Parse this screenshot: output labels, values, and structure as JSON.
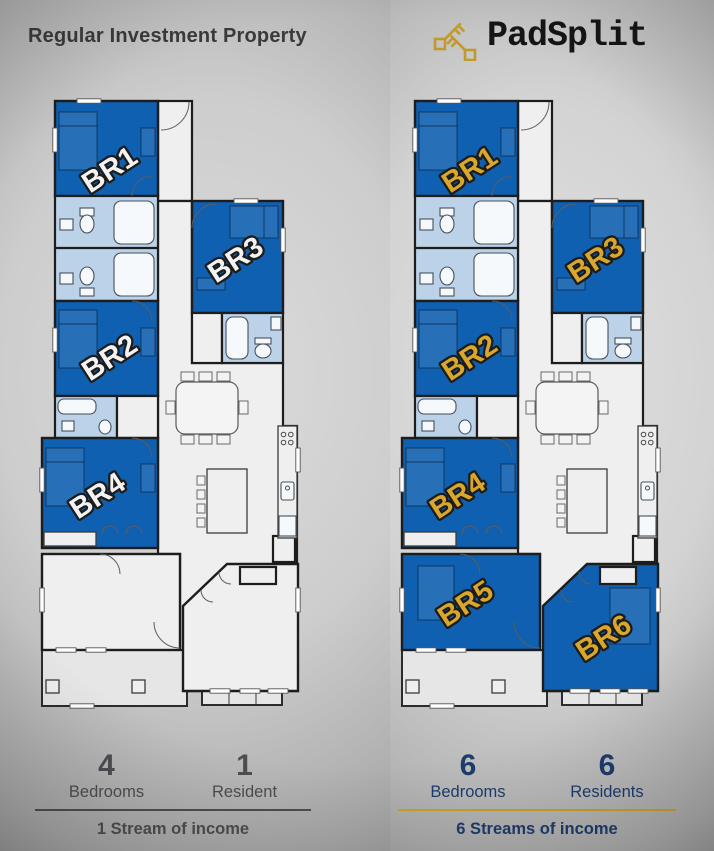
{
  "header": {
    "title": "Regular Investment Property",
    "brand": "PadSplit",
    "brand_icon": "keys-icon"
  },
  "plans": {
    "left": {
      "name": "regular-floorplan",
      "label_color": "#f3f3f3",
      "extra_room_fill": "#efefef",
      "rooms": [
        {
          "label": "BR1"
        },
        {
          "label": "BR2"
        },
        {
          "label": "BR3"
        },
        {
          "label": "BR4"
        }
      ]
    },
    "right": {
      "name": "padsplit-floorplan",
      "label_color": "#d9a72c",
      "extra_room_fill": "#0f60b0",
      "rooms": [
        {
          "label": "BR1"
        },
        {
          "label": "BR2"
        },
        {
          "label": "BR3"
        },
        {
          "label": "BR4"
        },
        {
          "label": "BR5"
        },
        {
          "label": "BR6"
        }
      ]
    }
  },
  "stats": {
    "left": {
      "items": [
        {
          "value": "4",
          "label": "Bedrooms"
        },
        {
          "value": "1",
          "label": "Resident"
        }
      ],
      "income": "1 Stream of income"
    },
    "right": {
      "items": [
        {
          "value": "6",
          "label": "Bedrooms"
        },
        {
          "value": "6",
          "label": "Residents"
        }
      ],
      "income": "6 Streams of income"
    }
  },
  "colors": {
    "bedroom_blue": "#0f60b0",
    "bathroom_blue": "#bcd2e8",
    "left_accent": "#4e4e52",
    "right_accent": "#1d3d6d",
    "gold": "#c9a22b",
    "brand_black": "#151515"
  }
}
